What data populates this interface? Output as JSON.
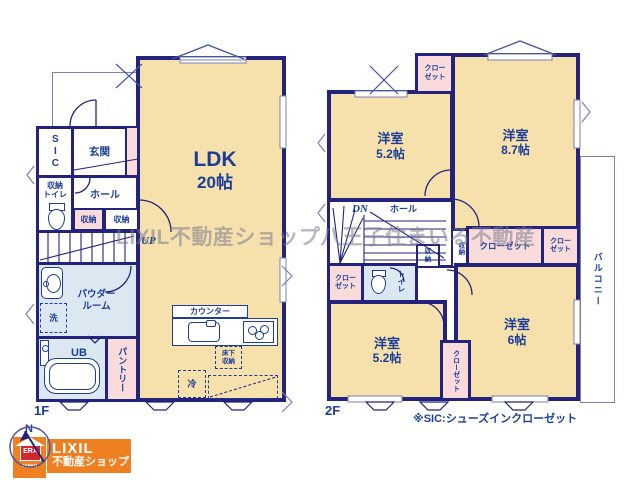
{
  "colors": {
    "wall": "#23237d",
    "text_navy": "#1c3e99",
    "room_cream": "#f6e0ac",
    "closet_pink": "#f9dbdb",
    "wet_area_blue": "#dce8f1",
    "logo_orange": "#ef8022",
    "era_red": "#d22630",
    "watermark_gray": "#7a7c8c"
  },
  "watermark": "LIXIL不動産ショップ八王子住まいる不動産",
  "note": "※SIC:シューズインクローゼット",
  "floor1": {
    "label": "1F",
    "ldk_name": "LDK",
    "ldk_size": "20帖",
    "sic": "SIC",
    "genkan": "玄関",
    "hall": "ホール",
    "wc_line1": "収納",
    "wc_line2": "トイレ",
    "storage_pink": "収納",
    "storage_white": "収納",
    "up": "UP",
    "powder_line1": "パウダー",
    "powder_line2": "ルーム",
    "washer": "洗",
    "bath": "UB",
    "pantry": "パントリー",
    "counter": "カウンター",
    "underfloor_line1": "床下",
    "underfloor_line2": "収納",
    "fridge": "冷"
  },
  "floor2": {
    "label": "2F",
    "dn": "DN",
    "hall": "ホール",
    "room_nw_name": "洋室",
    "room_nw_size": "5.2帖",
    "room_ne_name": "洋室",
    "room_ne_size": "8.7帖",
    "room_sw_name": "洋室",
    "room_sw_size": "5.2帖",
    "room_se_name": "洋室",
    "room_se_size": "6帖",
    "closet_top_l1": "クロー",
    "closet_top_l2": "ゼット",
    "closet_left_l1": "クロー",
    "closet_left_l2": "ゼット",
    "closet_wide": "クローゼット",
    "closet_small_l1": "クロー",
    "closet_small_l2": "ゼット",
    "closet_mid": "クローゼット",
    "storage_hall_l1": "収",
    "storage_hall_l2": "納",
    "storage_strip": "収納",
    "toilet": "トイレ",
    "balcony": "バルコニー"
  },
  "logo": {
    "north": "N",
    "era": "ERA",
    "era_sub": "JAPAN",
    "brand": "LIXIL",
    "brand_sub": "不動産ショップ"
  }
}
